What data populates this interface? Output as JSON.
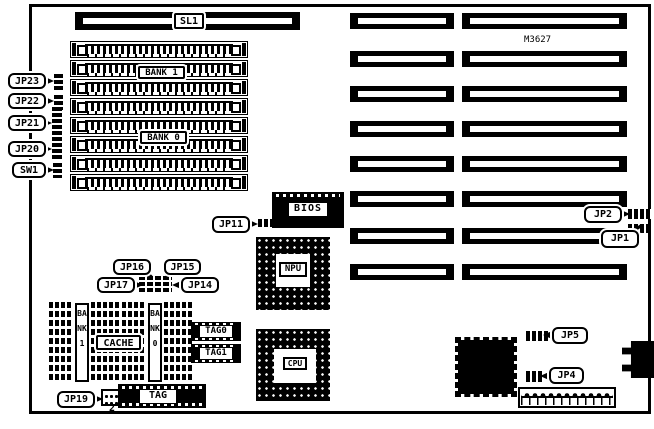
{
  "board": {
    "model_number": "M3627",
    "expansion_slot": "SL1",
    "memory_banks": {
      "bank1": "BANK 1",
      "bank0": "BANK 0"
    },
    "chips": {
      "bios": "BIOS",
      "npu": "NPU",
      "cpu": "CPU"
    },
    "cache": {
      "label": "CACHE",
      "bank1": "BANK 1",
      "bank0": "BANK 0",
      "tag0": "TAG0",
      "tag1": "TAG1",
      "tag": "TAG"
    },
    "jumpers": {
      "jp23": "JP23",
      "jp22": "JP22",
      "jp21": "JP21",
      "jp20": "JP20",
      "sw1": "SW1",
      "jp11": "JP11",
      "jp16": "JP16",
      "jp15": "JP15",
      "jp17": "JP17",
      "jp14": "JP14",
      "jp19": "JP19",
      "jp19_pin_label": "2",
      "jp5": "JP5",
      "jp4": "JP4",
      "jp2": "JP2",
      "jp1": "JP1"
    }
  }
}
